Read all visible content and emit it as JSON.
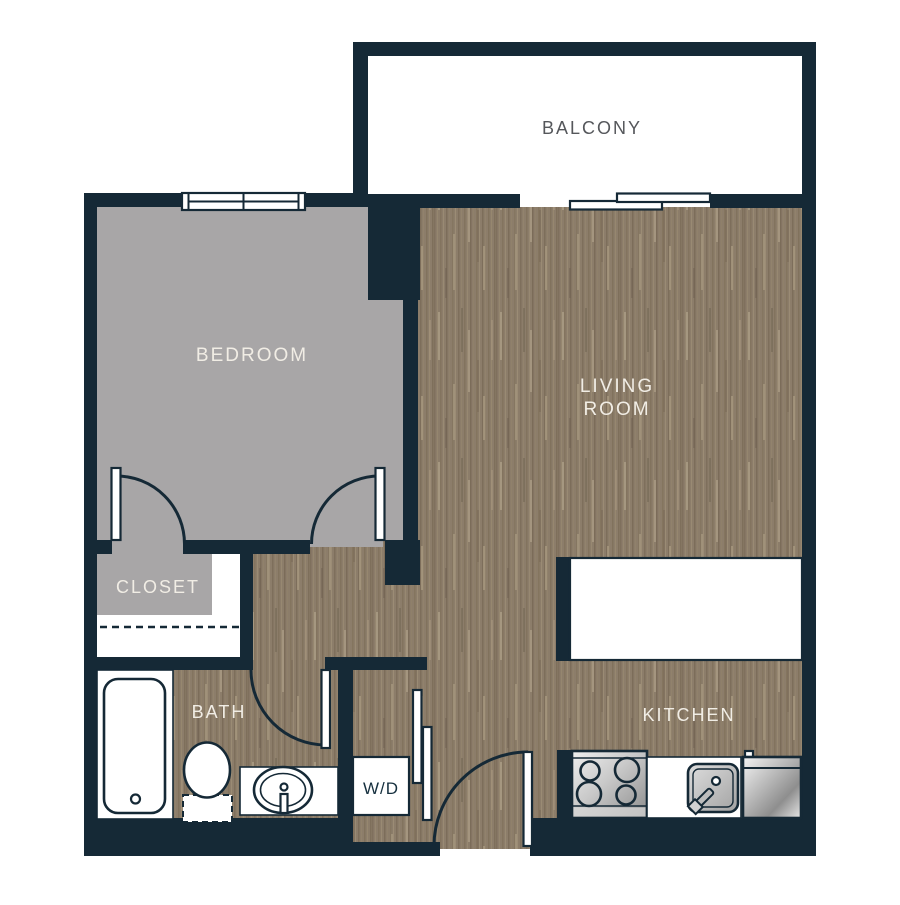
{
  "floorplan": {
    "rooms": {
      "balcony": {
        "label": "BALCONY"
      },
      "bedroom": {
        "label": "BEDROOM"
      },
      "living_room": {
        "label_line1": "LIVING",
        "label_line2": "ROOM"
      },
      "closet": {
        "label": "CLOSET"
      },
      "bath": {
        "label": "BATH"
      },
      "laundry": {
        "label": "W/D"
      },
      "kitchen": {
        "label": "KITCHEN"
      }
    },
    "colors": {
      "wall": "#152936",
      "wood_floor_base": "#8c7d6a",
      "bedroom_floor": "#a8a6a7",
      "room_label": "#f1ede5",
      "balcony_label": "#55575b",
      "laundry_label": "#16303f",
      "background": "#ffffff"
    }
  }
}
